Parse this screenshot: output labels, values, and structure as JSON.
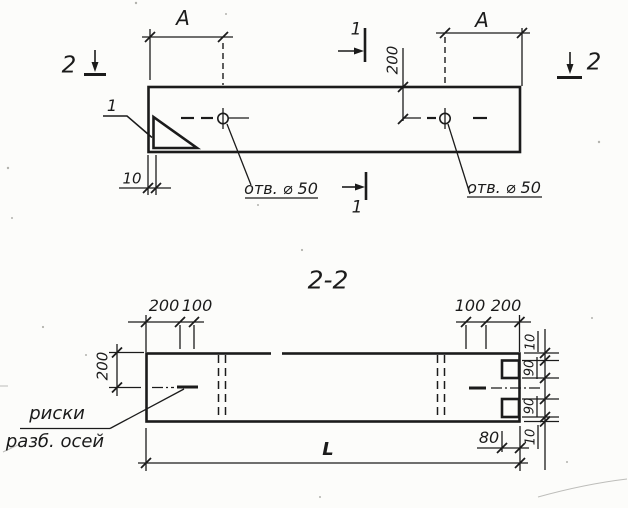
{
  "colors": {
    "paper": "#fcfcfa",
    "ink": "#1b1b1b"
  },
  "plan_view": {
    "section_marker_left": "2",
    "section_marker_right": "2",
    "cut_marker_top": "1",
    "cut_marker_bottom": "1",
    "detail_callout": "1",
    "dim_a_left": "A",
    "dim_a_right": "A",
    "dim_hole_offset": "200",
    "dim_end_riska": "10",
    "hole_label_left": "отв. ⌀ 50",
    "hole_label_right": "отв. ⌀ 50"
  },
  "section_view": {
    "title": "2-2",
    "dim_top_left_outer": "200",
    "dim_top_left_inner": "100",
    "dim_top_right_inner": "100",
    "dim_top_right_outer": "200",
    "dim_axis_offset": "200",
    "riska_note_line1": "риски",
    "riska_note_line2": "разб. осей",
    "dim_overall_length": "L",
    "dim_groove_depth": "80",
    "right_chain": [
      "10",
      "90",
      "90",
      "10"
    ]
  }
}
